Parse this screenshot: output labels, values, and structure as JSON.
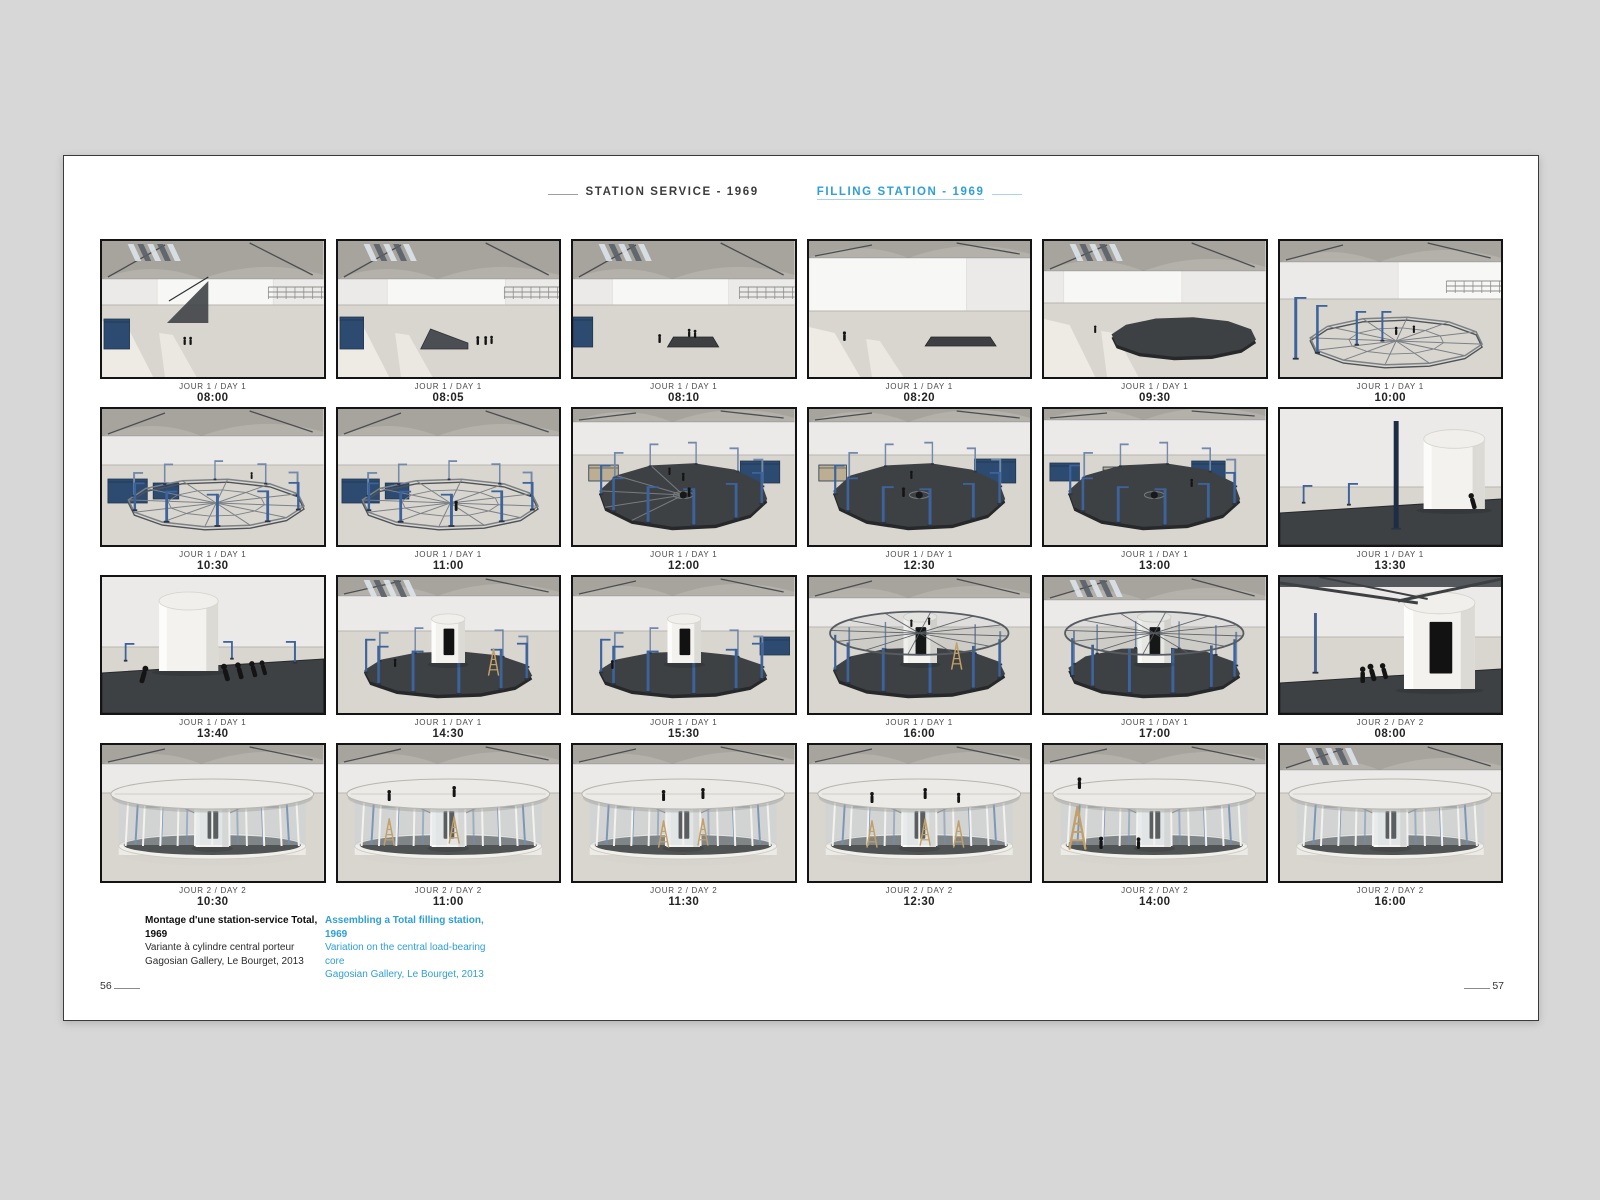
{
  "header": {
    "title_fr": "STATION SERVICE - 1969",
    "title_en": "FILLING STATION - 1969",
    "accent": "#2e9fd8"
  },
  "footer": {
    "fr": {
      "l1": "Montage d'une station-service Total, 1969",
      "l2": "Variante à cylindre central porteur",
      "l3": "Gagosian Gallery, Le Bourget, 2013"
    },
    "en": {
      "l1": "Assembling a Total filling station, 1969",
      "l2": "Variation on the central load-bearing core",
      "l3": "Gagosian Gallery, Le Bourget, 2013"
    },
    "page_left": "56",
    "page_right": "57"
  },
  "colors": {
    "wall": "#eceae8",
    "wallPanel": "#f7f7f5",
    "ceil": "#b4b1ab",
    "ceil2": "#a7a49e",
    "truss": "#3b3e42",
    "floor": "#d9d6d0",
    "sun": "#f7f4ec",
    "deck": "#3e4144",
    "deckEdge": "#26282a",
    "frame": "#7c8186",
    "steel": "#3c639c",
    "steelBack": "#7289a9",
    "crate": "#2d4a70",
    "cyl": "#f3f2ee",
    "door": "#121212",
    "glass": "#c9d3d8",
    "fascia": "#edebe6",
    "roof": "#575c62",
    "ladder": "#c2a068",
    "person": "#141414"
  },
  "photos": [
    {
      "day": "JOUR 1 / DAY 1",
      "time": "08:00",
      "sc": {
        "hor": 64,
        "ceil": 1,
        "sky": 1,
        "wall": {
          "x": 56,
          "w": 118,
          "h": 46
        },
        "mezz": 1,
        "sun": 1,
        "stair": 66,
        "crates": [
          [
            2,
            78,
            26,
            30
          ]
        ],
        "ppl": [
          [
            84,
            104,
            1.2,
            0
          ],
          [
            90,
            104,
            1.2,
            0
          ]
        ]
      }
    },
    {
      "day": "JOUR 1 / DAY 1",
      "time": "08:05",
      "sc": {
        "hor": 64,
        "ceil": 1,
        "sky": 1,
        "wall": {
          "x": 50,
          "w": 120,
          "h": 46
        },
        "mezz": 1,
        "sun": 1,
        "crates": [
          [
            2,
            76,
            24,
            32
          ]
        ],
        "stack": {
          "x": 84,
          "y": 88,
          "w": 48,
          "h": 20,
          "k": 1
        },
        "ppl": [
          [
            142,
            104,
            1.3,
            0
          ],
          [
            150,
            104,
            1.3,
            0
          ],
          [
            156,
            103,
            1.2,
            0
          ]
        ]
      }
    },
    {
      "day": "JOUR 1 / DAY 1",
      "time": "08:10",
      "sc": {
        "hor": 64,
        "ceil": 1,
        "sky": 1,
        "wall": {
          "x": 40,
          "w": 118,
          "h": 46
        },
        "mezz": 1,
        "crates": [
          [
            0,
            76,
            20,
            30
          ]
        ],
        "stack": {
          "x": 96,
          "y": 96,
          "w": 52,
          "h": 10,
          "k": 0
        },
        "ppl": [
          [
            88,
            102,
            1.3,
            0
          ],
          [
            118,
            96,
            1.2,
            0
          ],
          [
            124,
            97,
            1.2,
            0
          ]
        ]
      }
    },
    {
      "day": "JOUR 1 / DAY 1",
      "time": "08:20",
      "sc": {
        "hor": 70,
        "ceil": 0.45,
        "wall": {
          "x": 0,
          "w": 160,
          "h": 62
        },
        "sun": 1,
        "stack": {
          "x": 118,
          "y": 96,
          "w": 72,
          "h": 9,
          "k": 0
        },
        "ppl": [
          [
            36,
            100,
            1.4,
            0
          ]
        ]
      }
    },
    {
      "day": "JOUR 1 / DAY 1",
      "time": "09:30",
      "sc": {
        "hor": 62,
        "ceil": 0.8,
        "sky": 1,
        "wall": {
          "x": 20,
          "w": 120,
          "h": 44
        },
        "sun": 1,
        "deck": {
          "cx": 142,
          "cy": 96,
          "rx": 74,
          "ry": 20,
          "solid": 1
        },
        "ppl": [
          [
            52,
            92,
            1.1,
            0
          ]
        ]
      }
    },
    {
      "day": "JOUR 1 / DAY 1",
      "time": "10:00",
      "sc": {
        "hor": 58,
        "ceil": 0.55,
        "wall": {
          "x": 120,
          "w": 105,
          "h": 42
        },
        "mezz": 1,
        "deck": {
          "cx": 118,
          "cy": 100,
          "rx": 88,
          "ry": 24,
          "frame": 1
        },
        "cols": [
          [
            16,
            118,
            62,
            3,
            1
          ],
          [
            38,
            112,
            48,
            2.6,
            1
          ],
          [
            78,
            104,
            34,
            2.2,
            1
          ],
          [
            104,
            100,
            30,
            2,
            1
          ]
        ],
        "ppl": [
          [
            118,
            94,
            1.2,
            0
          ],
          [
            136,
            92,
            1.1,
            0
          ]
        ]
      }
    },
    {
      "day": "JOUR 1 / DAY 1",
      "time": "10:30",
      "sc": {
        "hor": 56,
        "ceil": 0.7,
        "crates": [
          [
            6,
            70,
            40,
            24
          ],
          [
            52,
            74,
            26,
            16
          ]
        ],
        "deck": {
          "cx": 116,
          "cy": 94,
          "rx": 90,
          "ry": 24,
          "frame": 1
        },
        "ring": {
          "n": 10,
          "h": 26,
          "arm": 1
        },
        "ppl": [
          [
            152,
            70,
            1,
            0
          ]
        ]
      }
    },
    {
      "day": "JOUR 1 / DAY 1",
      "time": "11:00",
      "sc": {
        "hor": 56,
        "ceil": 0.7,
        "crates": [
          [
            4,
            70,
            38,
            24
          ],
          [
            48,
            74,
            24,
            16
          ]
        ],
        "deck": {
          "cx": 114,
          "cy": 94,
          "rx": 90,
          "ry": 24,
          "frame": 1
        },
        "ring": {
          "n": 10,
          "h": 26,
          "arm": 1
        },
        "ppl": [
          [
            120,
            102,
            1.5,
            0
          ]
        ]
      }
    },
    {
      "day": "JOUR 1 / DAY 1",
      "time": "12:00",
      "sc": {
        "hor": 46,
        "ceil": 0.35,
        "crates": [
          [
            16,
            56,
            30,
            16,
            "#bcae92"
          ],
          [
            170,
            52,
            40,
            22
          ]
        ],
        "deck": {
          "cx": 112,
          "cy": 86,
          "rx": 86,
          "ry": 32,
          "solid": 1,
          "frame": 0.5,
          "hub": 1
        },
        "ring": {
          "n": 11,
          "h": 30,
          "arm": 1
        },
        "ppl": [
          [
            98,
            66,
            1.1,
            0
          ],
          [
            112,
            72,
            1.2,
            0
          ],
          [
            118,
            88,
            1.4,
            0
          ]
        ]
      }
    },
    {
      "day": "JOUR 1 / DAY 1",
      "time": "12:30",
      "sc": {
        "hor": 46,
        "ceil": 0.35,
        "crates": [
          [
            10,
            56,
            28,
            16,
            "#bcae92"
          ],
          [
            168,
            50,
            42,
            24
          ]
        ],
        "deck": {
          "cx": 112,
          "cy": 86,
          "rx": 88,
          "ry": 32,
          "solid": 1,
          "hub": 1
        },
        "ring": {
          "n": 11,
          "h": 30,
          "arm": 1
        },
        "ppl": [
          [
            104,
            70,
            1.2,
            0
          ],
          [
            96,
            88,
            1.4,
            0
          ]
        ]
      }
    },
    {
      "day": "JOUR 1 / DAY 1",
      "time": "13:00",
      "sc": {
        "hor": 46,
        "ceil": 0.3,
        "crates": [
          [
            6,
            54,
            30,
            18
          ],
          [
            60,
            58,
            20,
            12,
            "#bcae92"
          ],
          [
            150,
            52,
            34,
            20
          ]
        ],
        "deck": {
          "cx": 112,
          "cy": 86,
          "rx": 88,
          "ry": 32,
          "solid": 1,
          "hub": 1
        },
        "ring": {
          "n": 11,
          "h": 30,
          "arm": 1
        },
        "ppl": [
          [
            150,
            78,
            1.2,
            0
          ]
        ]
      }
    },
    {
      "day": "JOUR 1 / DAY 1",
      "time": "13:30",
      "sc": {
        "hor": 78,
        "ceil": 0,
        "band": 96,
        "cyl": {
          "x": 146,
          "y": 30,
          "w": 62,
          "h": 70,
          "door": 0
        },
        "cols": [
          [
            70,
            96,
            22,
            2,
            1
          ],
          [
            24,
            94,
            18,
            1.8,
            1
          ],
          [
            118,
            120,
            108,
            5,
            0,
            "#1e2c45"
          ]
        ],
        "ppl": [
          [
            198,
            100,
            2.4,
            -1
          ]
        ]
      }
    },
    {
      "day": "JOUR 1 / DAY 1",
      "time": "13:40",
      "sc": {
        "hor": 70,
        "ceil": 0,
        "band": 88,
        "cyl": {
          "x": 58,
          "y": 24,
          "w": 60,
          "h": 70,
          "door": 0
        },
        "cols": [
          [
            24,
            84,
            18,
            1.8,
            1
          ],
          [
            132,
            82,
            18,
            1.8,
            1
          ],
          [
            196,
            86,
            22,
            2,
            1
          ]
        ],
        "ppl": [
          [
            40,
            106,
            2.6,
            1
          ],
          [
            128,
            104,
            2.6,
            -1
          ],
          [
            142,
            102,
            2.5,
            -1
          ],
          [
            156,
            100,
            2.4,
            -1
          ],
          [
            166,
            98,
            2.2,
            -1
          ]
        ]
      }
    },
    {
      "day": "JOUR 1 / DAY 1",
      "time": "14:30",
      "sc": {
        "hor": 54,
        "ceil": 0.5,
        "sky": 1,
        "deck": {
          "cx": 112,
          "cy": 96,
          "rx": 86,
          "ry": 22,
          "solid": 1
        },
        "ring": {
          "n": 11,
          "h": 34,
          "arm": 1
        },
        "cyl": {
          "x": 95,
          "y": 42,
          "w": 34,
          "h": 44,
          "door": 1
        },
        "lad": [
          [
            158,
            72,
            0
          ]
        ],
        "ppl": [
          [
            58,
            90,
            1.2,
            0
          ]
        ]
      }
    },
    {
      "day": "JOUR 1 / DAY 1",
      "time": "15:30",
      "sc": {
        "hor": 54,
        "ceil": 0.5,
        "deck": {
          "cx": 112,
          "cy": 96,
          "rx": 86,
          "ry": 22,
          "solid": 1
        },
        "ring": {
          "n": 11,
          "h": 34,
          "arm": 1
        },
        "cyl": {
          "x": 96,
          "y": 42,
          "w": 34,
          "h": 44,
          "door": 1
        },
        "crates": [
          [
            190,
            60,
            30,
            18
          ]
        ],
        "ppl": [
          [
            40,
            92,
            1.3,
            0
          ]
        ]
      }
    },
    {
      "day": "JOUR 1 / DAY 1",
      "time": "16:00",
      "sc": {
        "hor": 50,
        "ceil": 0.55,
        "deck": {
          "cx": 112,
          "cy": 94,
          "rx": 88,
          "ry": 24,
          "solid": 1
        },
        "ring": {
          "n": 11,
          "h": 36
        },
        "roof": 1,
        "cyl": {
          "x": 96,
          "y": 40,
          "w": 34,
          "h": 46,
          "door": 1
        },
        "lad": [
          [
            150,
            66,
            0
          ]
        ],
        "ppl": [
          [
            104,
            50,
            1.1,
            0
          ],
          [
            122,
            48,
            1.1,
            0
          ]
        ]
      }
    },
    {
      "day": "JOUR 1 / DAY 1",
      "time": "17:00",
      "sc": {
        "hor": 50,
        "ceil": 0.6,
        "sky": 1,
        "deck": {
          "cx": 112,
          "cy": 94,
          "rx": 88,
          "ry": 24,
          "solid": 1
        },
        "ring": {
          "n": 12,
          "h": 36
        },
        "roof": 1,
        "cyl": {
          "x": 95,
          "y": 40,
          "w": 34,
          "h": 46,
          "door": 1
        }
      }
    },
    {
      "day": "JOUR 2 / DAY 2",
      "time": "08:00",
      "sc": {
        "hor": 60,
        "ceil": 0,
        "beamsTop": 1,
        "band": 98,
        "cyl": {
          "x": 126,
          "y": 26,
          "w": 72,
          "h": 86,
          "door": 1
        },
        "cols": [
          [
            36,
            96,
            60,
            3,
            0,
            "#46648f"
          ]
        ],
        "ppl": [
          [
            96,
            104,
            2.6,
            -1
          ],
          [
            108,
            102,
            2.4,
            -1
          ],
          [
            84,
            106,
            2.4,
            0
          ]
        ]
      }
    },
    {
      "day": "JOUR 2 / DAY 2",
      "time": "10:30",
      "sc": {
        "hor": 48,
        "ceil": 0.5,
        "pav": 1
      }
    },
    {
      "day": "JOUR 2 / DAY 2",
      "time": "11:00",
      "sc": {
        "hor": 48,
        "ceil": 0.5,
        "pav": 1,
        "lad": [
          [
            52,
            74,
            0
          ],
          [
            118,
            72,
            0
          ]
        ],
        "ppl": [
          [
            52,
            56,
            1.6,
            0
          ],
          [
            118,
            52,
            1.6,
            0
          ]
        ]
      }
    },
    {
      "day": "JOUR 2 / DAY 2",
      "time": "11:30",
      "sc": {
        "hor": 48,
        "ceil": 0.5,
        "pav": 1,
        "lad": [
          [
            92,
            76,
            0
          ],
          [
            132,
            74,
            0
          ]
        ],
        "ppl": [
          [
            92,
            56,
            1.6,
            0
          ],
          [
            132,
            54,
            1.6,
            0
          ]
        ]
      }
    },
    {
      "day": "JOUR 2 / DAY 2",
      "time": "12:30",
      "sc": {
        "hor": 48,
        "ceil": 0.5,
        "pav": 1,
        "lad": [
          [
            64,
            76,
            0
          ],
          [
            118,
            74,
            0
          ],
          [
            152,
            76,
            0
          ]
        ],
        "ppl": [
          [
            64,
            58,
            1.6,
            0
          ],
          [
            118,
            54,
            1.6,
            0
          ],
          [
            152,
            58,
            1.5,
            0
          ]
        ]
      }
    },
    {
      "day": "JOUR 2 / DAY 2",
      "time": "14:00",
      "sc": {
        "hor": 48,
        "ceil": 0.5,
        "pav": 1,
        "lad": [
          [
            34,
            62,
            1
          ]
        ],
        "ppl": [
          [
            36,
            44,
            1.7,
            0
          ],
          [
            58,
            104,
            1.8,
            0
          ],
          [
            96,
            104,
            1.7,
            0
          ]
        ]
      }
    },
    {
      "day": "JOUR 2 / DAY 2",
      "time": "16:00",
      "sc": {
        "hor": 48,
        "ceil": 0.65,
        "sky": 1,
        "pav": 1
      }
    }
  ]
}
